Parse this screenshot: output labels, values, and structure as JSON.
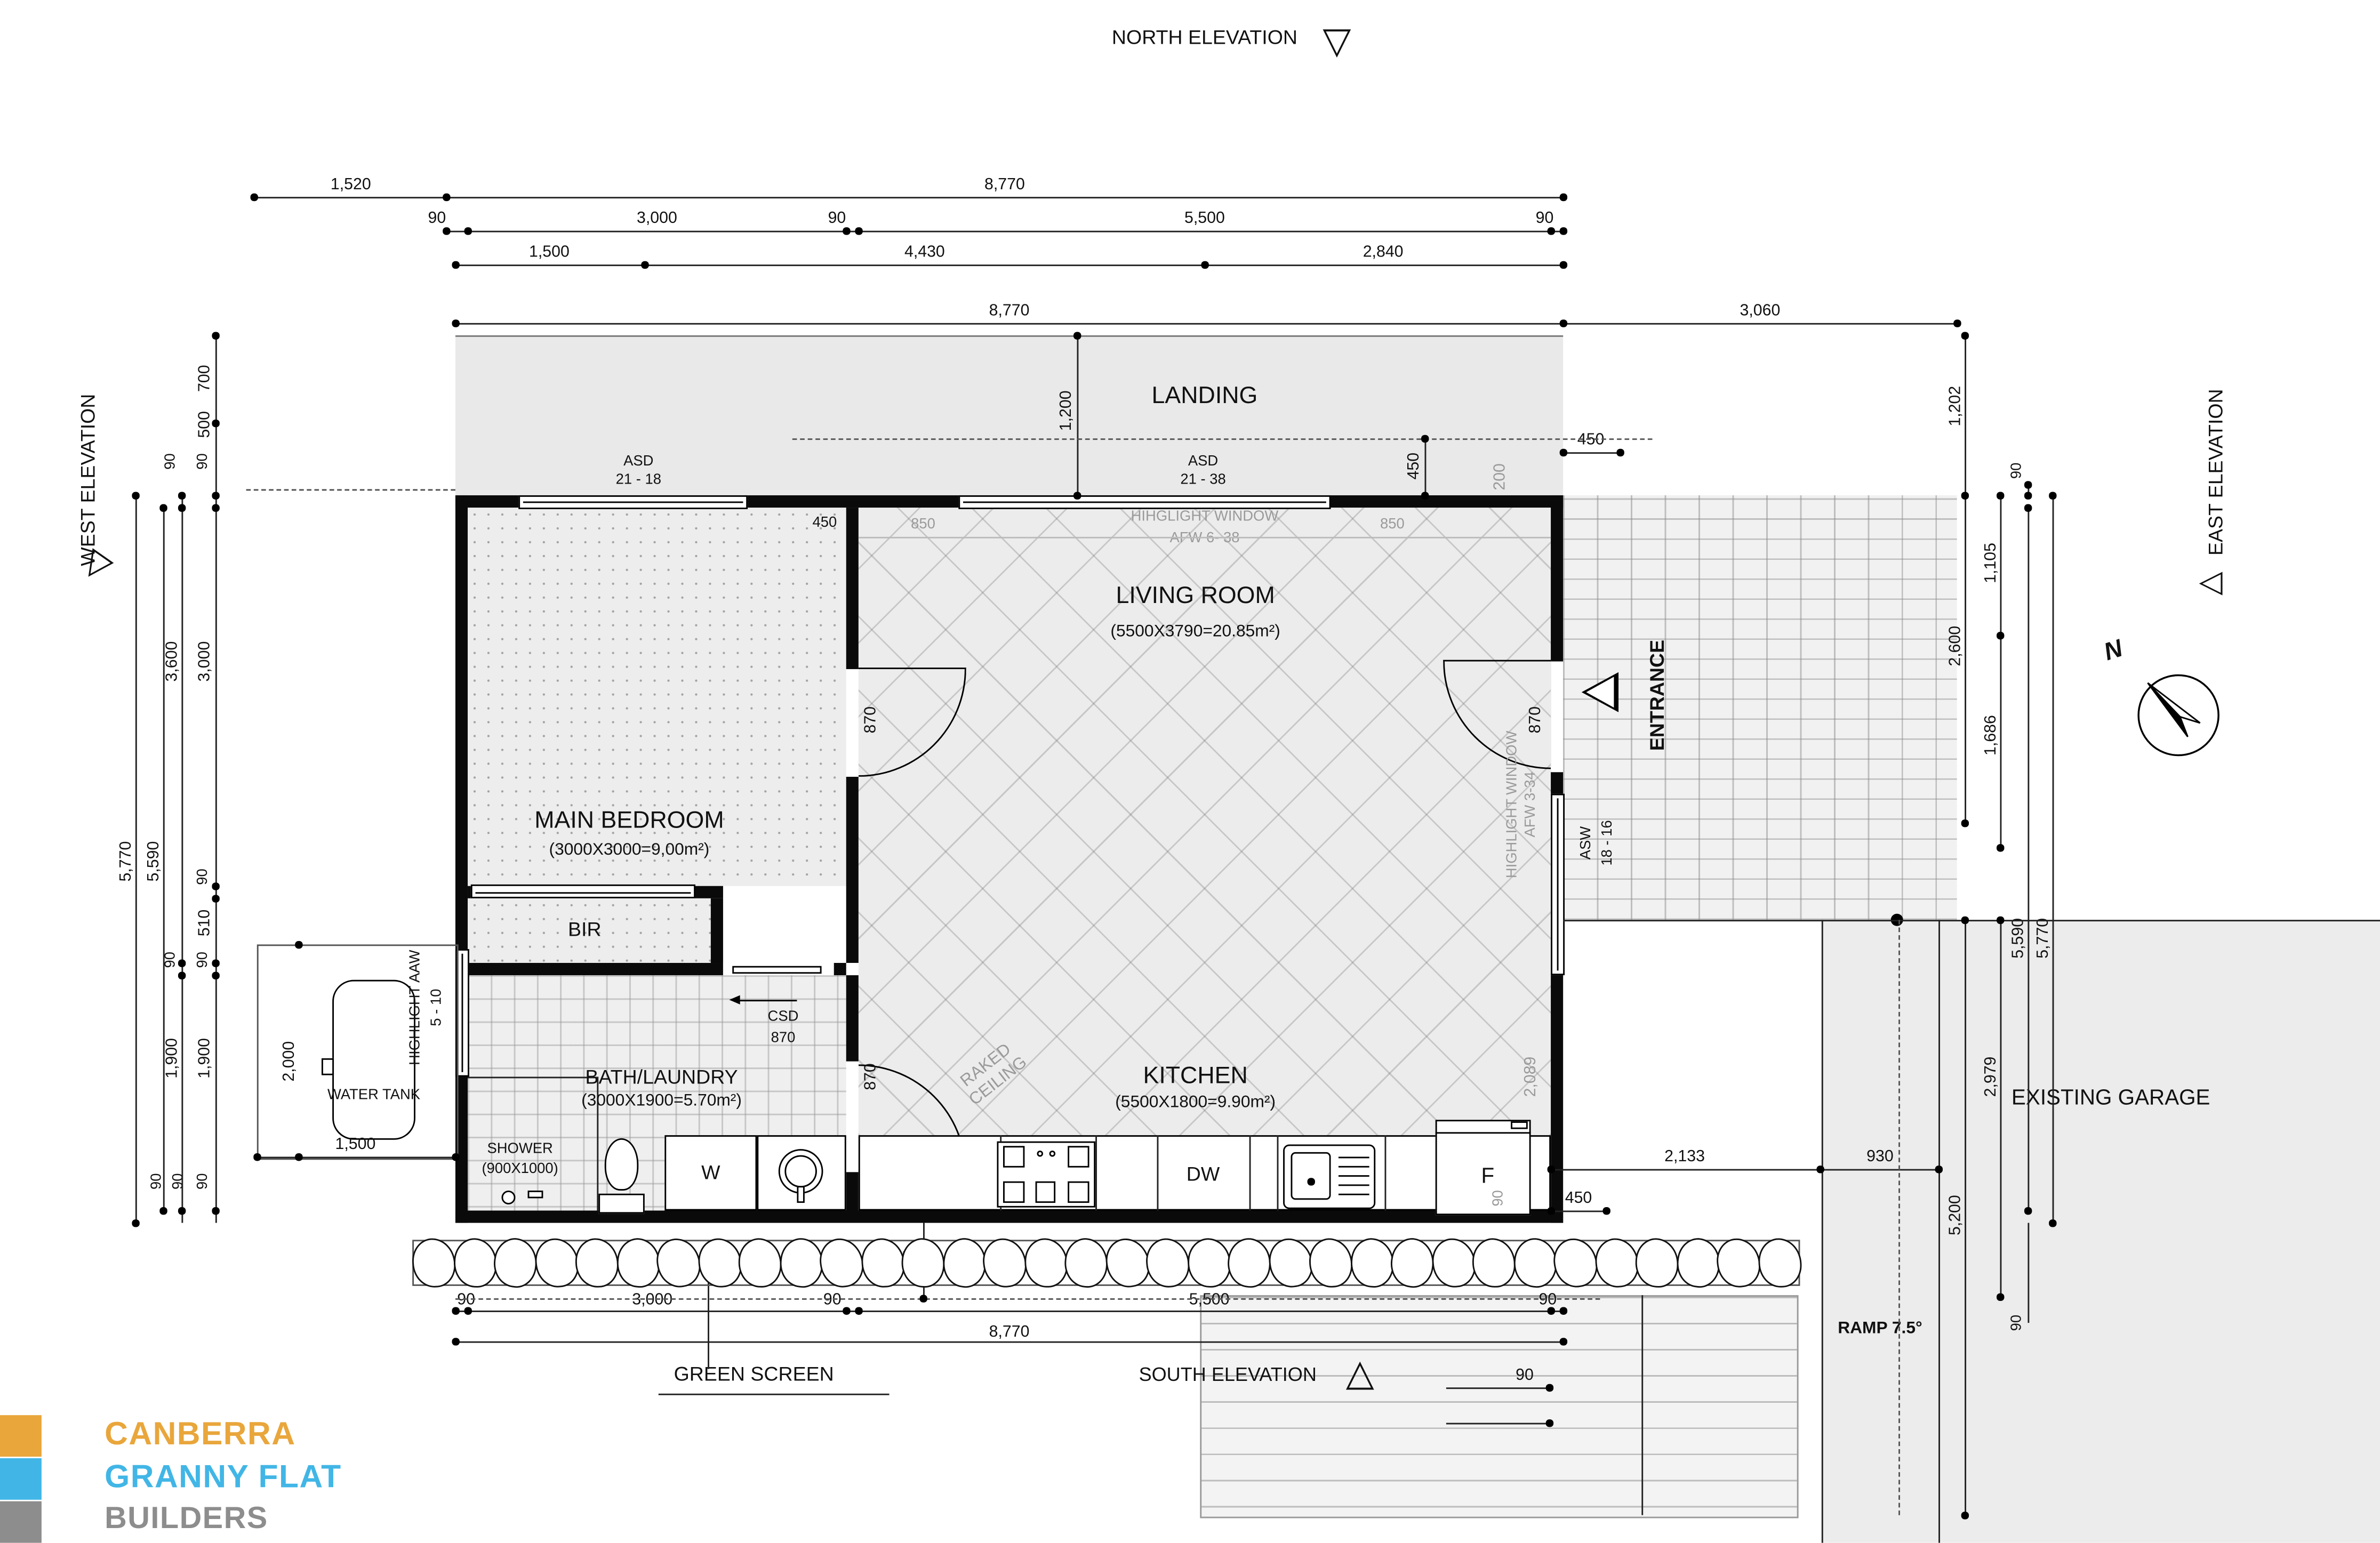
{
  "elevations": {
    "north": "NORTH ELEVATION",
    "south": "SOUTH ELEVATION",
    "east": "EAST ELEVATION",
    "west": "WEST ELEVATION"
  },
  "icons": {
    "tri_down": "▽",
    "tri_up": "△",
    "tri_left": "◁"
  },
  "compass": {
    "n": "N"
  },
  "dims": {
    "top1": [
      "1,520",
      "8,770"
    ],
    "top2": [
      "90",
      "3,000",
      "90",
      "5,500",
      "90"
    ],
    "top3": [
      "1,500",
      "4,430",
      "2,840"
    ],
    "top4": [
      "8,770",
      "3,060"
    ],
    "landing": {
      "v1200": "1,200",
      "v450": "450",
      "h450": "450",
      "g200": "200",
      "g850": "850",
      "black450": "450"
    },
    "left": {
      "i": [
        "700",
        "500",
        "90",
        "3,000",
        "90",
        "510",
        "90",
        "1,900"
      ],
      "m": [
        "90",
        "3,600",
        "90",
        "1,900"
      ],
      "o": [
        "5,590",
        "5,770"
      ],
      "b": [
        "90",
        "90",
        "90"
      ]
    },
    "right": {
      "top": [
        "1,202",
        "90",
        "1,105",
        "2,600",
        "1,686"
      ],
      "outer": [
        "5,590",
        "5,770"
      ],
      "garage": [
        "2,979",
        "5,200",
        "90"
      ],
      "h": [
        "2,133",
        "930",
        "450"
      ]
    },
    "bottom": {
      "row1": [
        "90",
        "3,000",
        "90",
        "5,500",
        "90"
      ],
      "row2": "8,770",
      "v450": "450",
      "d90": "90"
    },
    "kitchen": {
      "g2089": "2,089",
      "g90": "90"
    },
    "tank": {
      "v": "2,000",
      "h": "1,500"
    }
  },
  "windows": {
    "asd1": [
      "ASD",
      "21 - 18"
    ],
    "asd2": [
      "ASD",
      "21 - 38"
    ],
    "hw_top": [
      "HIHGLIGHT WINDOW",
      "AFW 6- 38"
    ],
    "hw_east": [
      "HIGHLIGHT WINDOW",
      "AFW 3-34"
    ],
    "asw": [
      "ASW",
      "18 - 16"
    ],
    "aaw": [
      "HIGHLIGHT AAW",
      "5 - 10"
    ]
  },
  "doors": {
    "csd": "CSD",
    "w870": "870"
  },
  "rooms": {
    "landing": "LANDING",
    "living": {
      "name": "LIVING ROOM",
      "area": "(5500X3790=20.85m²)"
    },
    "bedroom": {
      "name": "MAIN BEDROOM",
      "area": "(3000X3000=9,00m²)"
    },
    "bir": "BIR",
    "bath": {
      "name": "BATH/LAUNDRY",
      "area": "(3000X1900=5.70m²)"
    },
    "shower": {
      "name": "SHOWER",
      "size": "(900X1000)"
    },
    "kitchen": {
      "name": "KITCHEN",
      "area": "(5500X1800=9.90m²)"
    },
    "raked": "RAKED CEILING",
    "entrance": "ENTRANCE",
    "garage": "EXISTING GARAGE",
    "ramp": "RAMP 7.5°",
    "green_screen": "GREEN SCREEN",
    "water_tank": "WATER TANK"
  },
  "appliances": {
    "w": "W",
    "dw": "DW",
    "f": "F"
  },
  "logo": {
    "line1": "CANBERRA",
    "line2": "GRANNY FLAT",
    "line3": "BUILDERS",
    "color1": "#E9A63B",
    "color2": "#41B6E6",
    "color3": "#8D8D8D"
  }
}
